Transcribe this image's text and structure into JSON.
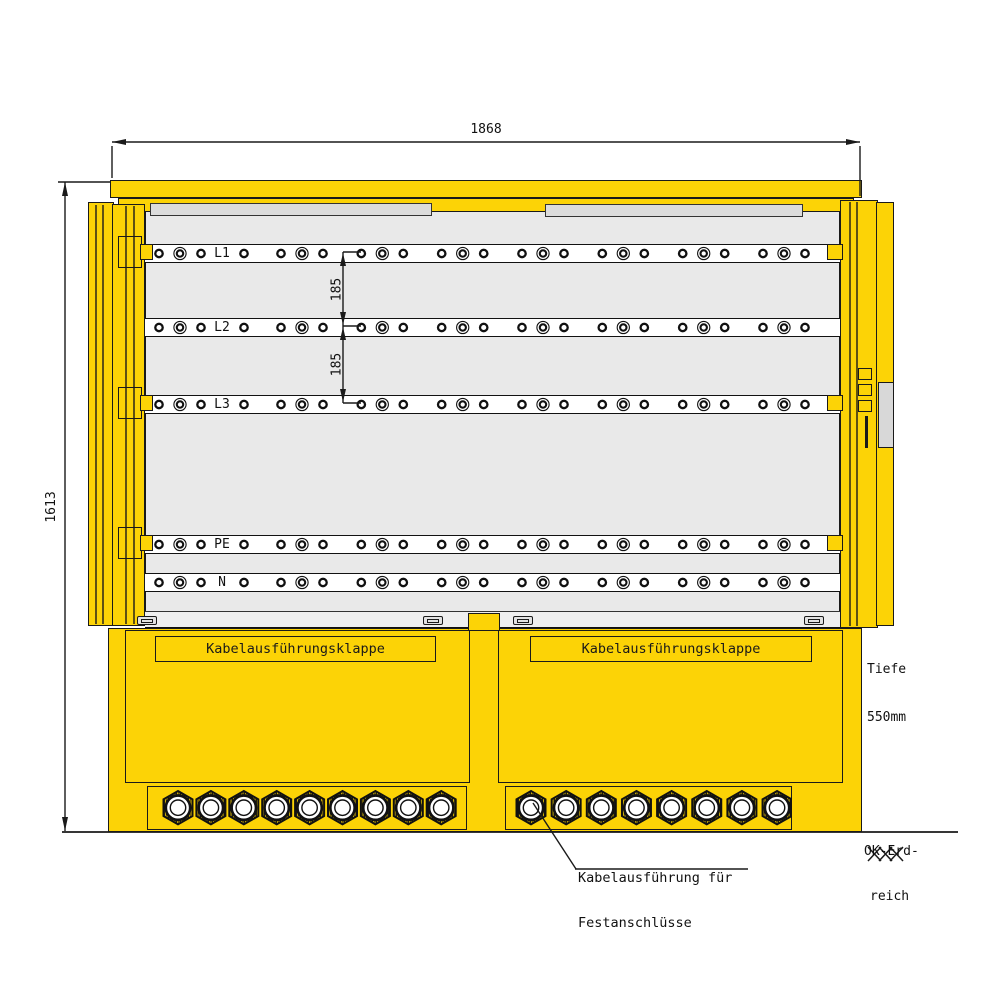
{
  "dimensions": {
    "overall_width": "1868",
    "overall_height": "1613",
    "busbar_spacing_1": "185",
    "busbar_spacing_2": "185"
  },
  "busbars": {
    "labels": [
      "L1",
      "L2",
      "L3",
      "PE",
      "N"
    ],
    "hole_groups_per_bar": 8
  },
  "flaps": {
    "left_label": "Kabelausführungsklappe",
    "right_label": "Kabelausführungsklappe"
  },
  "depth_note": {
    "line1": "Tiefe",
    "line2": "550mm"
  },
  "ground_note": {
    "line1": "OK-Erd-",
    "line2": "reich"
  },
  "callout": {
    "line1": "Kabelausführung für",
    "line2": "Festanschlüsse"
  },
  "glands": {
    "left_count": 9,
    "right_count": 8
  },
  "colors": {
    "cabinet_yellow": "#FCD306",
    "interior_gray": "#E9E9E9",
    "panel_gray": "#DCDCDC",
    "handle_gray": "#D8D8D8",
    "line_black": "#1A1A1A"
  }
}
